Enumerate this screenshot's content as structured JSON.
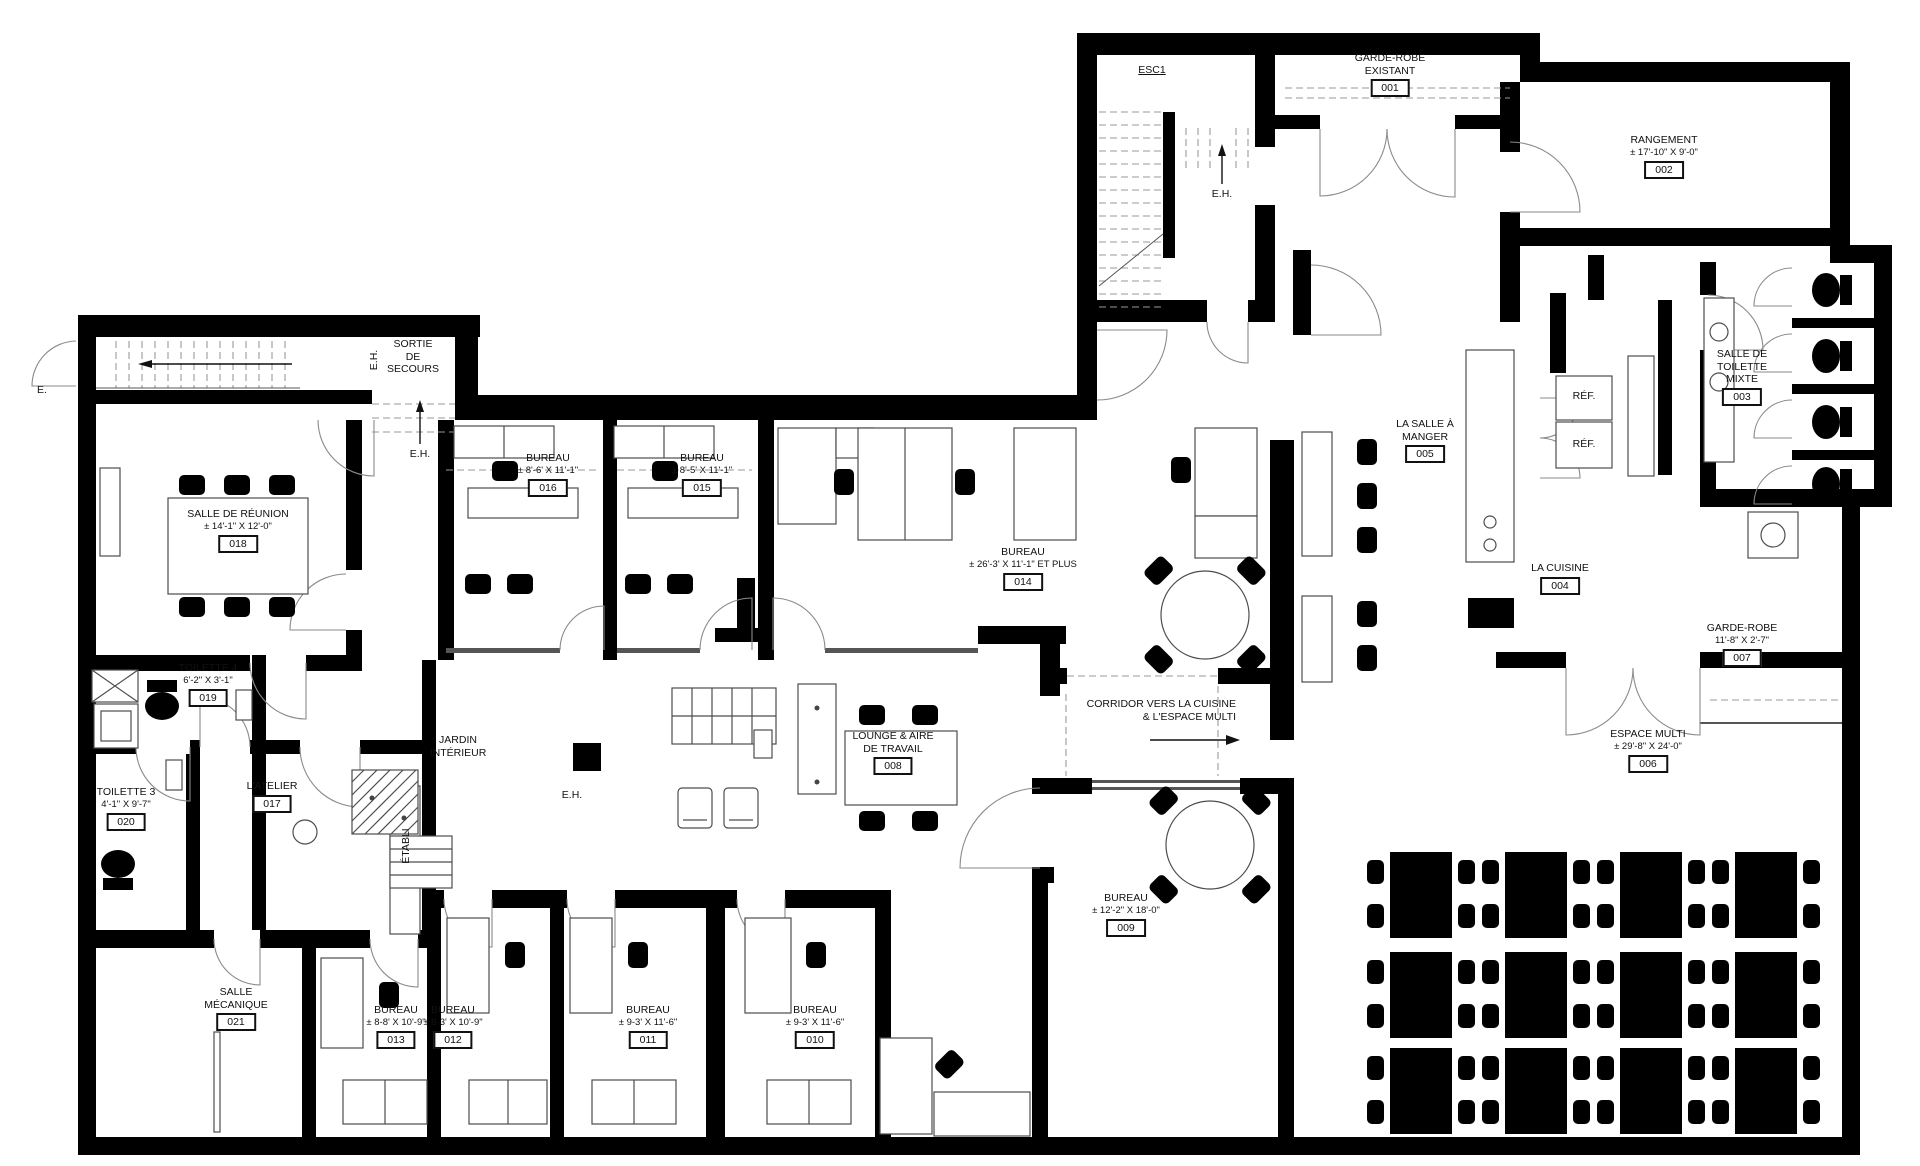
{
  "colors": {
    "wall": "#000000",
    "furniture_line": "#4d4d4d",
    "text": "#111111"
  },
  "rooms": {
    "001": {
      "name": "GARDE-ROBE",
      "name2": "EXISTANT",
      "number": "001"
    },
    "002": {
      "name": "RANGEMENT",
      "dims": "± 17'-10\" X 9'-0\"",
      "number": "002"
    },
    "003": {
      "name": "SALLE DE",
      "name2": "TOILETTE",
      "name3": "MIXTE",
      "number": "003"
    },
    "004": {
      "name": "LA CUISINE",
      "number": "004"
    },
    "005": {
      "name": "LA SALLE À",
      "name2": "MANGER",
      "number": "005"
    },
    "006": {
      "name": "ESPACE MULTI",
      "dims": "± 29'-8\" X 24'-0\"",
      "number": "006"
    },
    "007": {
      "name": "GARDE-ROBE",
      "dims": "11'-8\" X 2'-7\"",
      "number": "007"
    },
    "008": {
      "name": "LOUNGE & AIRE",
      "name2": "DE TRAVAIL",
      "number": "008"
    },
    "009": {
      "name": "BUREAU",
      "dims": "± 12'-2\" X 18'-0\"",
      "number": "009"
    },
    "010": {
      "name": "BUREAU",
      "dims": "± 9-3' X 11'-6\"",
      "number": "010"
    },
    "011": {
      "name": "BUREAU",
      "dims": "± 9-3' X 11'-6\"",
      "number": "011"
    },
    "012": {
      "name": "BUREAU",
      "dims": "± 8-3' X 10'-9\"",
      "number": "012"
    },
    "013": {
      "name": "BUREAU",
      "dims": "± 8-8' X 10'-9\"",
      "number": "013"
    },
    "014": {
      "name": "BUREAU",
      "dims": "± 26'-3' X 11'-1\" ET PLUS",
      "number": "014"
    },
    "015": {
      "name": "BUREAU",
      "dims": "± 8'-5' X 11'-1\"",
      "number": "015"
    },
    "016": {
      "name": "BUREAU",
      "dims": "± 8'-6' X 11'-1\"",
      "number": "016"
    },
    "017": {
      "name": "L'ATELIER",
      "number": "017"
    },
    "018": {
      "name": "SALLE DE RÉUNION",
      "dims": "± 14'-1\" X 12'-0\"",
      "number": "018"
    },
    "019": {
      "name": "TOILETTE 4",
      "dims": "6'-2\" X 3'-1\"",
      "number": "019"
    },
    "020": {
      "name": "TOILETTE 3",
      "dims": "4'-1\" X 9'-7\"",
      "number": "020"
    },
    "021": {
      "name": "SALLE",
      "name2": "MÉCANIQUE",
      "number": "021"
    }
  },
  "annotations": {
    "esc1": "ESC1",
    "eh": "E.H.",
    "sortie1": "SORTIE",
    "sortie2": "DE",
    "sortie3": "SECOURS",
    "refrigerator": "RÉF.",
    "etabli": "ÉTABLI",
    "jardin1": "JARDIN",
    "jardin2": "INTÉRIEUR",
    "corridor1": "CORRIDOR VERS LA CUISINE",
    "corridor2": "& L'ESPACE MULTI",
    "entry": "E."
  }
}
